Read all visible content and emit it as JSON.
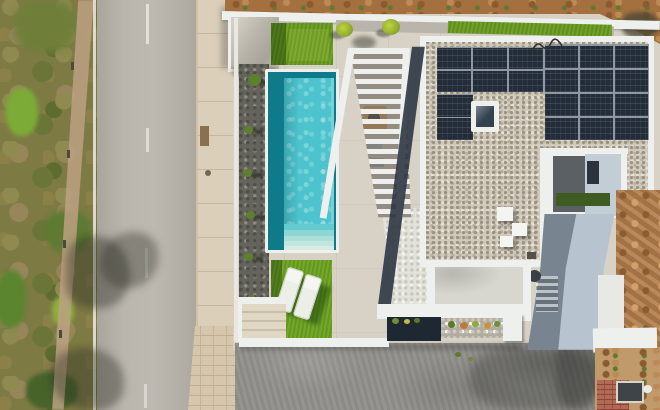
{
  "scene": {
    "type": "aerial-drone-photo",
    "description": "Top-down aerial photograph of a modern white villa: rectangular turquoise swimming pool with entry steps, travertine terrace, artificial-grass squares with two white sun loungers, louvred pergola over a dining area, flat gravel roof with photovoltaic solar array and skylight, inner courtyard, concrete ramp, grey driveway, asphalt road with dashed centre line beside a scrubland verge, sidewalk, excavated earth mound and brick paving on the neighbouring plot.",
    "objects": [
      "scrub vegetation verge",
      "dirt footpath",
      "asphalt road",
      "dashed centre line",
      "road edge line",
      "tree shadows on road",
      "concrete sidewalk",
      "paver strip",
      "white boundary wall",
      "entrance canopy",
      "dark gravel planting bed with shrubs",
      "artificial grass square",
      "rectangular swimming pool",
      "pool steps",
      "artificial grass with two sun loungers",
      "garden steps",
      "louvred pergola",
      "outdoor dining table",
      "parasol",
      "white pebble side yard",
      "flat gravel roof",
      "solar panel arrays",
      "roof skylight",
      "roof vents",
      "cable on roof",
      "inner courtyard",
      "concrete access ramp",
      "lower terrace",
      "planting beds",
      "white pillar",
      "grey concrete driveway",
      "earth mound with rocks",
      "brick paving patch",
      "drain cover",
      "neighbouring plot ground"
    ]
  },
  "palette": {
    "vegetation": "#7e7a44",
    "road": "#b7b2aa",
    "roadLine": "#eceae4",
    "sidewalk": "#dbcfba",
    "travertine": "#d8d2c6",
    "wallWhite": "#eef0ed",
    "gravelDark": "#64645c",
    "poolEdge": "#0f7a8a",
    "poolWater": "#4cc3cd",
    "grass": "#6aa01e",
    "grassTop": "#66991c",
    "whiteGravel": "#e3e2da",
    "roofGravel": "#d0c9bc",
    "solarPanel": "#232d39",
    "skylightGlass": "#33424f",
    "courtyardFloor": "#5b6064",
    "courtyardWall": "#c2cdd6",
    "ramp": "#b7c4d0",
    "terraceFloor": "#d7d6cf",
    "bedDark": "#1e2833",
    "bedLight": "#b2aba0",
    "driveway": "#92908b",
    "dirtTop": "#a5703f",
    "dirtMound": "#b07c4a",
    "groundTan": "#c09a6a",
    "brickRed": "#b06a55",
    "drainGrey": "#3f4448",
    "shadowDark": "#2e3644",
    "tableWood": "#bf8a4d",
    "parasol": "#d9ccb3"
  }
}
